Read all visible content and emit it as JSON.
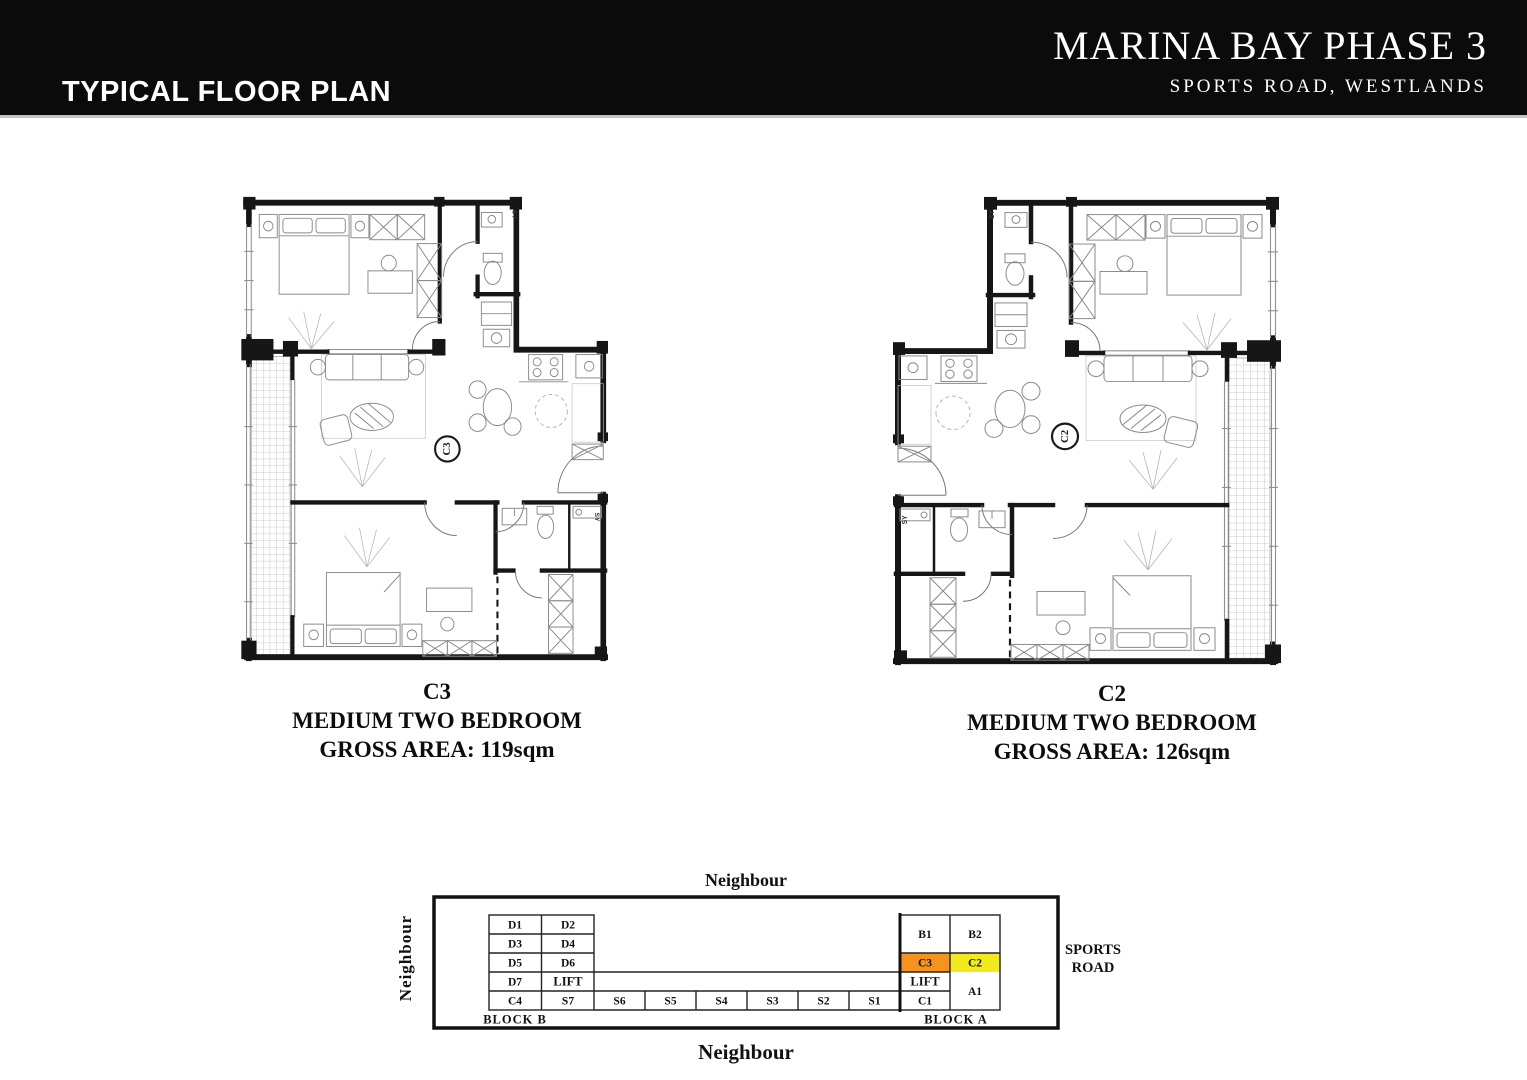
{
  "header": {
    "title_left": "TYPICAL FLOOR PLAN",
    "project_name": "MARINA BAY PHASE 3",
    "project_address": "SPORTS ROAD, WESTLANDS"
  },
  "units": [
    {
      "code": "C3",
      "type": "MEDIUM TWO BEDROOM",
      "area": "GROSS AREA: 119sqm",
      "shaft_label": "SY"
    },
    {
      "code": "C2",
      "type": "MEDIUM TWO BEDROOM",
      "area": "GROSS AREA: 126sqm",
      "shaft_label": "SY"
    }
  ],
  "key_plan": {
    "neighbour_top": "Neighbour",
    "neighbour_bottom": "Neighbour",
    "neighbour_left": "Neighbour",
    "road_line1": "SPORTS",
    "road_line2": "ROAD",
    "block_b_label": "BLOCK B",
    "block_a_label": "BLOCK A",
    "block_b_cells": [
      [
        "D1",
        "D2"
      ],
      [
        "D3",
        "D4"
      ],
      [
        "D5",
        "D6"
      ],
      [
        "D7",
        "LIFT"
      ],
      [
        "C4",
        "S7"
      ]
    ],
    "strip_cells": [
      "S6",
      "S5",
      "S4",
      "S3",
      "S2",
      "S1"
    ],
    "block_a_col1": [
      "B1",
      "C3",
      "LIFT",
      "C1"
    ],
    "block_a_col2": [
      "B2",
      "C2",
      "A1"
    ],
    "highlight_colors": {
      "c3": "#F6921E",
      "c2": "#F2EA1C"
    }
  },
  "colors": {
    "header_bar": "#0b0b0b",
    "ink": "#1a1a1a"
  }
}
